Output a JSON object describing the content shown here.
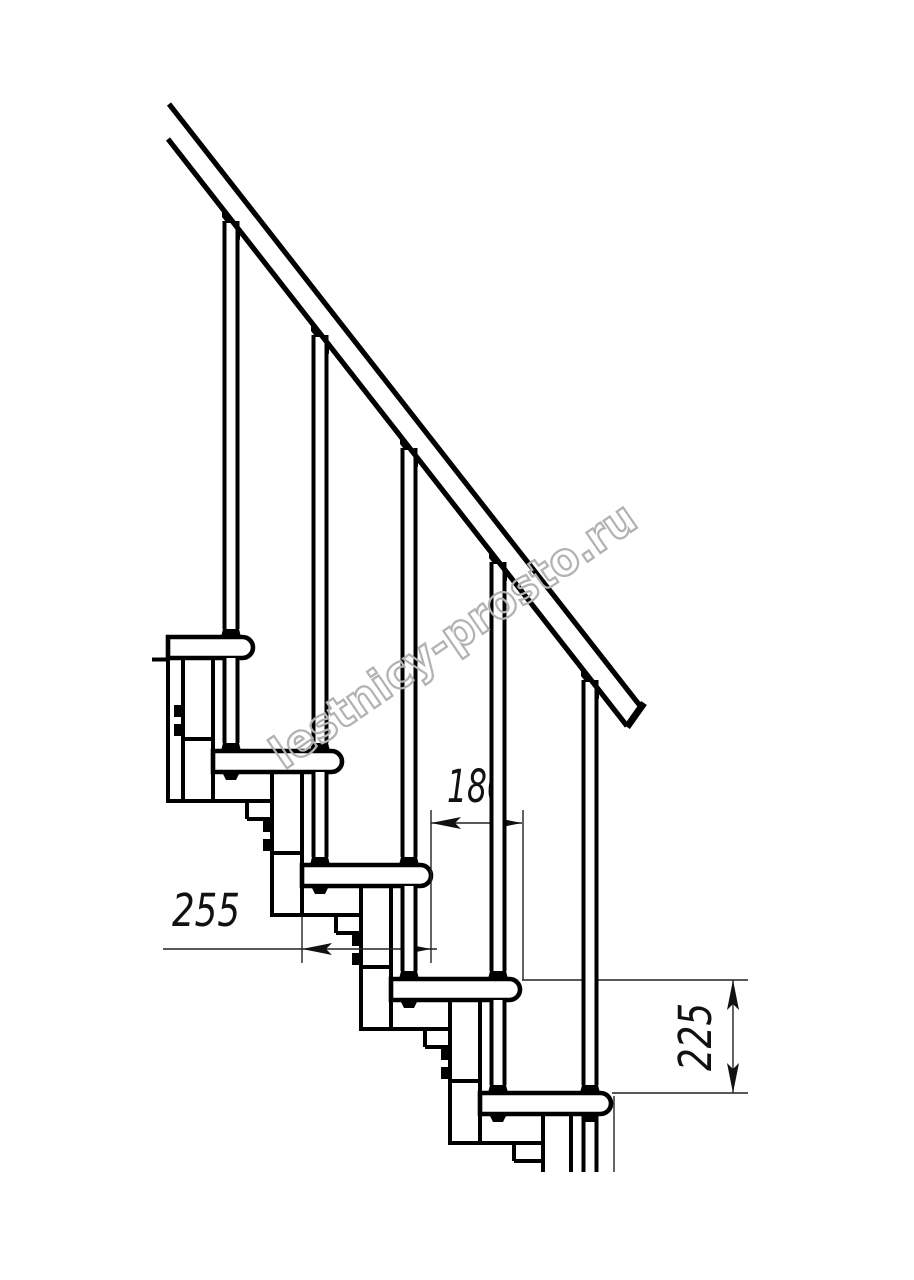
{
  "drawing": {
    "watermark": "lestnicy-prosto.ru",
    "dimensions": {
      "run": "180",
      "depth": "255",
      "riser": "225"
    }
  }
}
